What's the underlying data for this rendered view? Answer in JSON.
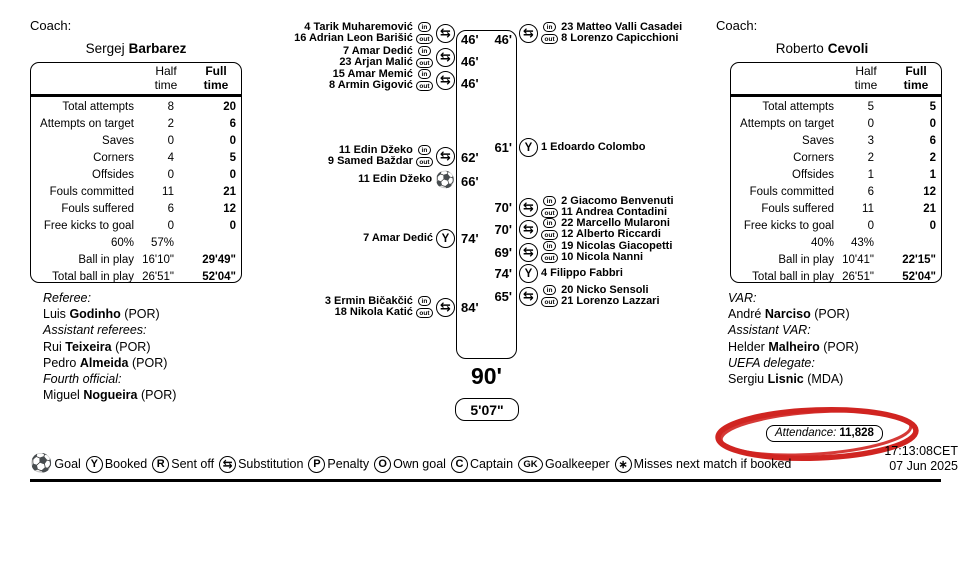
{
  "left_panel": {
    "coach_label": "Coach:",
    "coach": {
      "first": "Sergej",
      "last": "Barbarez"
    },
    "table": {
      "headers": {
        "half": "Half time",
        "full": "Full time"
      },
      "rows": [
        {
          "label": "Total attempts",
          "half": "8",
          "full": "20"
        },
        {
          "label": "Attempts on target",
          "half": "2",
          "full": "6"
        },
        {
          "label": "Saves",
          "half": "0",
          "full": "0"
        },
        {
          "label": "Corners",
          "half": "4",
          "full": "5"
        },
        {
          "label": "Offsides",
          "half": "0",
          "full": "0"
        },
        {
          "label": "Fouls committed",
          "half": "11",
          "full": "21"
        },
        {
          "label": "Fouls suffered",
          "half": "6",
          "full": "12"
        },
        {
          "label": "Free kicks to goal",
          "half": "0",
          "full": "0"
        },
        {
          "label": "60%",
          "half": "57%",
          "full": ""
        },
        {
          "label": "Ball in play",
          "half": "16'10\"",
          "full": "29'49\""
        },
        {
          "label": "Total ball in play",
          "half": "26'51\"",
          "full": "52'04\""
        }
      ]
    },
    "officials": {
      "lines": [
        {
          "kind": "role",
          "text": "Referee:"
        },
        {
          "kind": "name",
          "first": "Luis",
          "last": "Godinho",
          "suffix": " (POR)"
        },
        {
          "kind": "role",
          "text": "Assistant referees:"
        },
        {
          "kind": "name",
          "first": "Rui",
          "last": "Teixeira",
          "suffix": " (POR)"
        },
        {
          "kind": "name",
          "first": "Pedro",
          "last": "Almeida",
          "suffix": " (POR)"
        },
        {
          "kind": "role",
          "text": "Fourth official:"
        },
        {
          "kind": "name",
          "first": "Miguel",
          "last": "Nogueira",
          "suffix": " (POR)"
        }
      ]
    }
  },
  "right_panel": {
    "coach_label": "Coach:",
    "coach": {
      "first": "Roberto",
      "last": "Cevoli"
    },
    "table": {
      "headers": {
        "half": "Half time",
        "full": "Full time"
      },
      "rows": [
        {
          "label": "Total attempts",
          "half": "5",
          "full": "5"
        },
        {
          "label": "Attempts on target",
          "half": "0",
          "full": "0"
        },
        {
          "label": "Saves",
          "half": "3",
          "full": "6"
        },
        {
          "label": "Corners",
          "half": "2",
          "full": "2"
        },
        {
          "label": "Offsides",
          "half": "1",
          "full": "1"
        },
        {
          "label": "Fouls committed",
          "half": "6",
          "full": "12"
        },
        {
          "label": "Fouls suffered",
          "half": "11",
          "full": "21"
        },
        {
          "label": "Free kicks to goal",
          "half": "0",
          "full": "0"
        },
        {
          "label": "40%",
          "half": "43%",
          "full": ""
        },
        {
          "label": "Ball in play",
          "half": "10'41\"",
          "full": "22'15\""
        },
        {
          "label": "Total ball in play",
          "half": "26'51\"",
          "full": "52'04\""
        }
      ]
    },
    "officials": {
      "lines": [
        {
          "kind": "role",
          "text": "VAR:"
        },
        {
          "kind": "name",
          "first": "André",
          "last": "Narciso",
          "suffix": " (POR)"
        },
        {
          "kind": "role",
          "text": "Assistant VAR:"
        },
        {
          "kind": "name",
          "first": "Helder",
          "last": "Malheiro",
          "suffix": " (POR)"
        },
        {
          "kind": "role",
          "text": "UEFA delegate:"
        },
        {
          "kind": "name",
          "first": "Sergiu",
          "last": "Lisnic",
          "suffix": " (MDA)"
        }
      ]
    },
    "attendance": {
      "label": "Attendance:",
      "value": "11,828"
    },
    "timestamp": {
      "time": "17:13:08CET",
      "date": "07 Jun 2025"
    }
  },
  "timeline": {
    "end_time": "90'",
    "added_time": "5'07\"",
    "left_times": [
      "46'",
      "46'",
      "46'",
      "62'",
      "66'",
      "74'",
      "84'"
    ],
    "right_times": [
      "46'",
      "61'",
      "70'",
      "70'",
      "69'",
      "74'",
      "65'"
    ],
    "left_events": [
      {
        "type": "substitution",
        "in": "4 Tarik Muharemović",
        "out": "16 Adrian Leon Barišić"
      },
      {
        "type": "substitution",
        "in": "7 Amar Dedić",
        "out": "23 Arjan Malić"
      },
      {
        "type": "substitution",
        "in": "15 Amar Memić",
        "out": "8 Armin Gigović"
      },
      {
        "type": "substitution",
        "in": "11 Edin Džeko",
        "out": "9 Samed Baždar"
      },
      {
        "type": "goal",
        "player": "11 Edin Džeko"
      },
      {
        "type": "booked",
        "player": "7 Amar Dedić"
      },
      {
        "type": "substitution",
        "in": "3 Ermin Bičakčić",
        "out": "18 Nikola Katić"
      }
    ],
    "right_events": [
      {
        "type": "substitution",
        "in": "23 Matteo Valli Casadei",
        "out": "8 Lorenzo Capicchioni"
      },
      {
        "type": "booked",
        "player": "1 Edoardo Colombo"
      },
      {
        "type": "substitution",
        "in": "2 Giacomo Benvenuti",
        "out": "11 Andrea Contadini"
      },
      {
        "type": "substitution",
        "in": "22 Marcello Mularoni",
        "out": "12 Alberto Riccardi"
      },
      {
        "type": "substitution",
        "in": "19 Nicolas Giacopetti",
        "out": "10 Nicola Nanni"
      },
      {
        "type": "booked",
        "player": "4 Filippo Fabbri"
      },
      {
        "type": "substitution",
        "in": "20 Nicko Sensoli",
        "out": "21 Lorenzo Lazzari"
      }
    ]
  },
  "icons": {
    "in": "in",
    "out": "out",
    "substitution": "⇆",
    "booked": "Y",
    "sent_off": "R",
    "penalty": "P",
    "own_goal": "O",
    "captain": "C",
    "goalkeeper": "GK",
    "misses": "∗",
    "goal": "⚽"
  },
  "legend": {
    "items": [
      {
        "icon": "goal",
        "label": "Goal"
      },
      {
        "icon": "booked",
        "label": "Booked"
      },
      {
        "icon": "sent-off",
        "label": "Sent off"
      },
      {
        "icon": "substitution",
        "label": "Substitution"
      },
      {
        "icon": "penalty",
        "label": "Penalty"
      },
      {
        "icon": "own-goal",
        "label": "Own goal"
      },
      {
        "icon": "captain",
        "label": "Captain"
      },
      {
        "icon": "goalkeeper",
        "label": "Goalkeeper"
      },
      {
        "icon": "misses-next",
        "label": "Misses next match if booked"
      }
    ]
  },
  "colors": {
    "ink": "#000000",
    "annotation_red": "#d02521",
    "page_bg": "#ffffff"
  }
}
